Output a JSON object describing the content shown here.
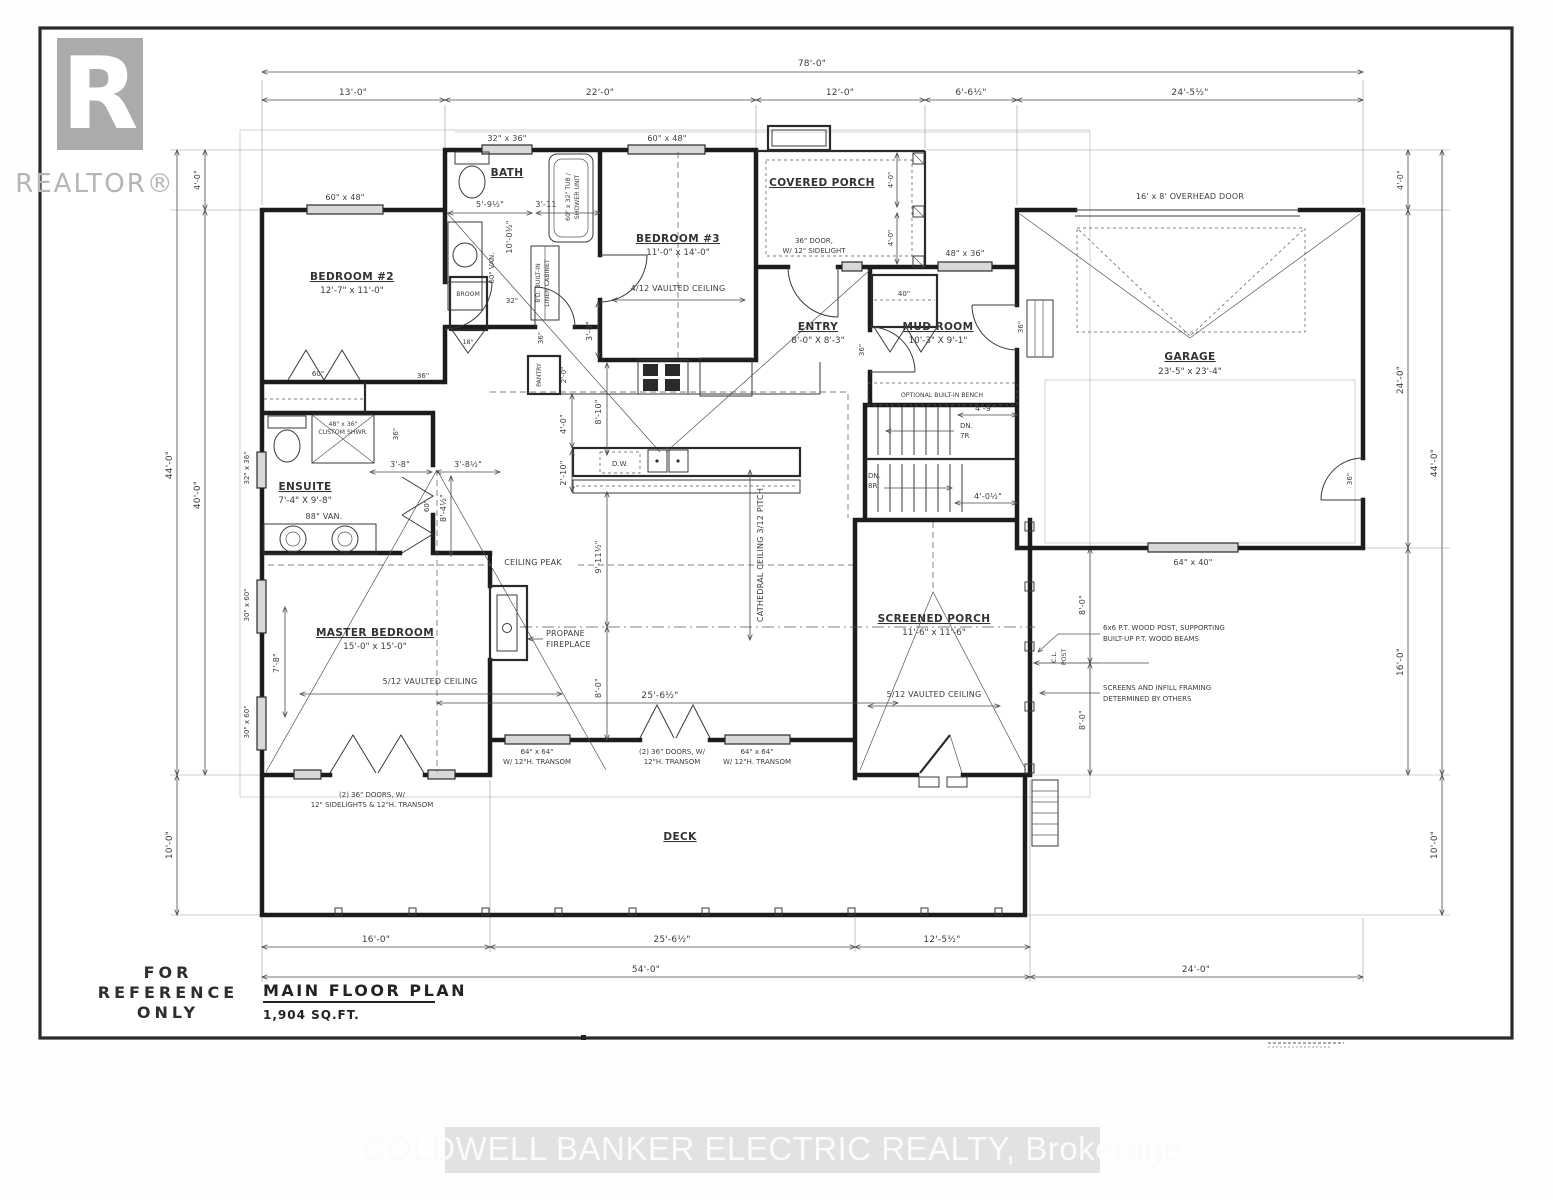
{
  "logo": {
    "letter": "R",
    "brand": "REALTOR®"
  },
  "stamp": {
    "line1": "FOR",
    "line2": "REFERENCE",
    "line3": "ONLY"
  },
  "title_block": {
    "title": "MAIN FLOOR PLAN",
    "area": "1,904 SQ.FT."
  },
  "watermark": "COLDWELL BANKER ELECTRIC REALTY, Brokerage",
  "dims": {
    "top": {
      "overall": "78'-0\"",
      "segments": [
        "13'-0\"",
        "22'-0\"",
        "12'-0\"",
        "6'-6½\"",
        "24'-5½\""
      ]
    },
    "left": {
      "d4": "4'-0\"",
      "d40": "40'-0\"",
      "d44": "44'-0\"",
      "d10": "10'-0\""
    },
    "right": {
      "d4": "4'-0\"",
      "d24": "24'-0\"",
      "d16": "16'-0\"",
      "d44": "44'-0\"",
      "d10": "10'-0\""
    },
    "bottom": {
      "d16": "16'-0\"",
      "d25": "25'-6½\"",
      "d12": "12'-5½\"",
      "d54": "54'-0\"",
      "d24": "24'-0\""
    }
  },
  "rooms": {
    "bedroom2": {
      "name": "BEDROOM #2",
      "size": "12'-7\" x 11'-0\""
    },
    "bath": {
      "name": "BATH"
    },
    "bedroom3": {
      "name": "BEDROOM #3",
      "size": "11'-0\" x 14'-0\"",
      "ceiling": "4/12 VAULTED CEILING"
    },
    "covered_porch": {
      "name": "COVERED PORCH"
    },
    "entry": {
      "name": "ENTRY",
      "size": "8'-0\" X 8'-3\""
    },
    "mud_room": {
      "name": "MUD ROOM",
      "size": "10'-3\" X 9'-1\""
    },
    "garage": {
      "name": "GARAGE",
      "size": "23'-5\" x 23'-4\""
    },
    "ensuite": {
      "name": "ENSUITE",
      "size": "7'-4\" X 9'-8\""
    },
    "master": {
      "name": "MASTER BEDROOM",
      "size": "15'-0\" x 15'-0\"",
      "ceiling": "5/12 VAULTED CEILING"
    },
    "screened_porch": {
      "name": "SCREENED PORCH",
      "size": "11'-6\" x 11'-6\"",
      "ceiling": "5/12 VAULTED CEILING"
    },
    "deck": {
      "name": "DECK"
    }
  },
  "labels": {
    "win_60x48": "60\" x 48\"",
    "win_32x36_top": "32\" x 36\"",
    "win_48x36": "48\" x 36\"",
    "win_64x40": "64\" x 40\"",
    "win_32x36_left": "32\" x 36\"",
    "win_30x60": "30\" x 60\"",
    "overhead_door": "16' x 8' OVERHEAD DOOR",
    "entry_door_l1": "36\" DOOR,",
    "entry_door_l2": "W/ 12\" SIDELIGHT",
    "bath_d1": "5'-9½\"",
    "bath_d2": "3'-11",
    "bath_d3": "10'-0½\"",
    "van60": "60\" VAN.",
    "van88": "88\" VAN.",
    "tub_l1": "60\" x 32\" TUB /",
    "tub_l2": "SHOWER UNIT",
    "linen_l1": "8'D. BUILT-IN",
    "linen_l2": "LINEN CABINET",
    "broom": "BROOM",
    "shwr_l1": "48\" x 36\"",
    "shwr_l2": "CUSTOM SHWR.",
    "pantry": "PANTRY",
    "dw": "D.W.",
    "bench": "OPTIONAL BUILT-IN BENCH",
    "dn": "DN.",
    "r7": "7R",
    "r8": "8R",
    "stair_d1": "4'-9\"",
    "stair_d2": "4'-0½\"",
    "ceiling_peak": "CEILING PEAK",
    "cathedral": "CATHEDRAL CEILING 3/12 PITCH",
    "fireplace_l1": "PROPANE",
    "fireplace_l2": "FIREPLACE",
    "post_note_l1": "6x6 P.T. WOOD POST, SUPPORTING",
    "post_note_l2": "BUILT-UP P.T. WOOD BEAMS",
    "screen_note_l1": "SCREENS AND INFILL FRAMING",
    "screen_note_l2": "DETERMINED BY OTHERS",
    "cl_l1": "C.L.",
    "cl_l2": "POST",
    "win64_l1": "64\" x 64\"",
    "win64_l2": "W/ 12\"H. TRANSOM",
    "doors2_l1": "(2) 36\" DOORS, W/",
    "doors2_l2": "12\"H. TRANSOM",
    "master_doors_l1": "(2) 36\" DOORS, W/",
    "master_doors_l2": "12\" SIDELIGHTS & 12\"H. TRANSOM",
    "d36": "36\"",
    "d32": "32\"",
    "d18": "18\"",
    "d40": "40\"",
    "d60": "60\"",
    "d3_8": "3'-8\"",
    "d3_8h": "3'-8½\"",
    "d8_4h": "8'-4½\"",
    "d7_8": "7'-8\"",
    "d2_0": "2'-0\"",
    "d4_0": "4'-0\"",
    "d8_10": "8'-10\"",
    "d2_10": "2'-10\"",
    "d9_11": "9'-11½\"",
    "d8_0": "8'-0\"",
    "d25_6": "25'-6½\""
  }
}
